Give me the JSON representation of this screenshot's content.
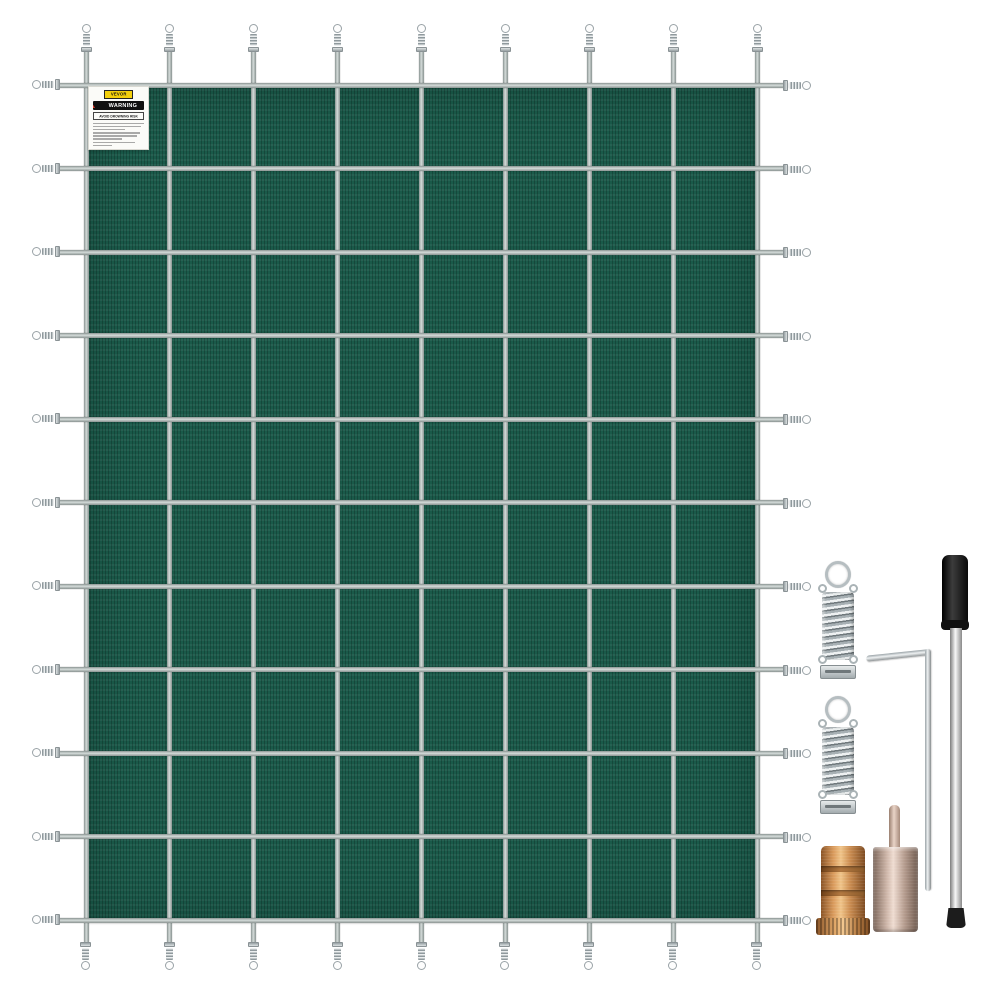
{
  "product": {
    "background": "#ffffff",
    "description": "Green mesh rectangular pool safety cover with strap grid, stainless springs and brass anchor installation hardware"
  },
  "cover": {
    "mesh_color": "#1a5a4a",
    "strap_color": "#b4bcba",
    "grid": {
      "columns": 8,
      "rows": 10,
      "left": 86,
      "top": 85,
      "width": 671,
      "height": 835,
      "strap_thickness": 5,
      "extent": {
        "top": 48,
        "bottom": 942,
        "left": 56,
        "right": 788
      },
      "spring_centers": {
        "top": 38,
        "bottom": 956,
        "left": 46,
        "right": 797
      }
    }
  },
  "label": {
    "brand": "VEVOR",
    "warning_word": "WARNING",
    "heading": "AVOID DROWNING RISK",
    "brand_bg": "#f3cf0b",
    "bar_bg": "#101010",
    "triangle_color": "#e03c2d",
    "fine_print_line_widths": [
      100,
      95,
      62,
      92,
      87,
      57,
      83,
      38
    ]
  },
  "hardware": {
    "spring_steel_color": "#c3cacd",
    "brass_color": "#cf9255",
    "tamp_tool_color": "#cdb5a8",
    "rod_handle_color": "#141414",
    "rod_shaft_color": "#d6d6d6",
    "items": [
      "cover-spring",
      "hex-key",
      "installation-rod",
      "cover-spring",
      "brass-anchor",
      "tamping-tool"
    ]
  }
}
